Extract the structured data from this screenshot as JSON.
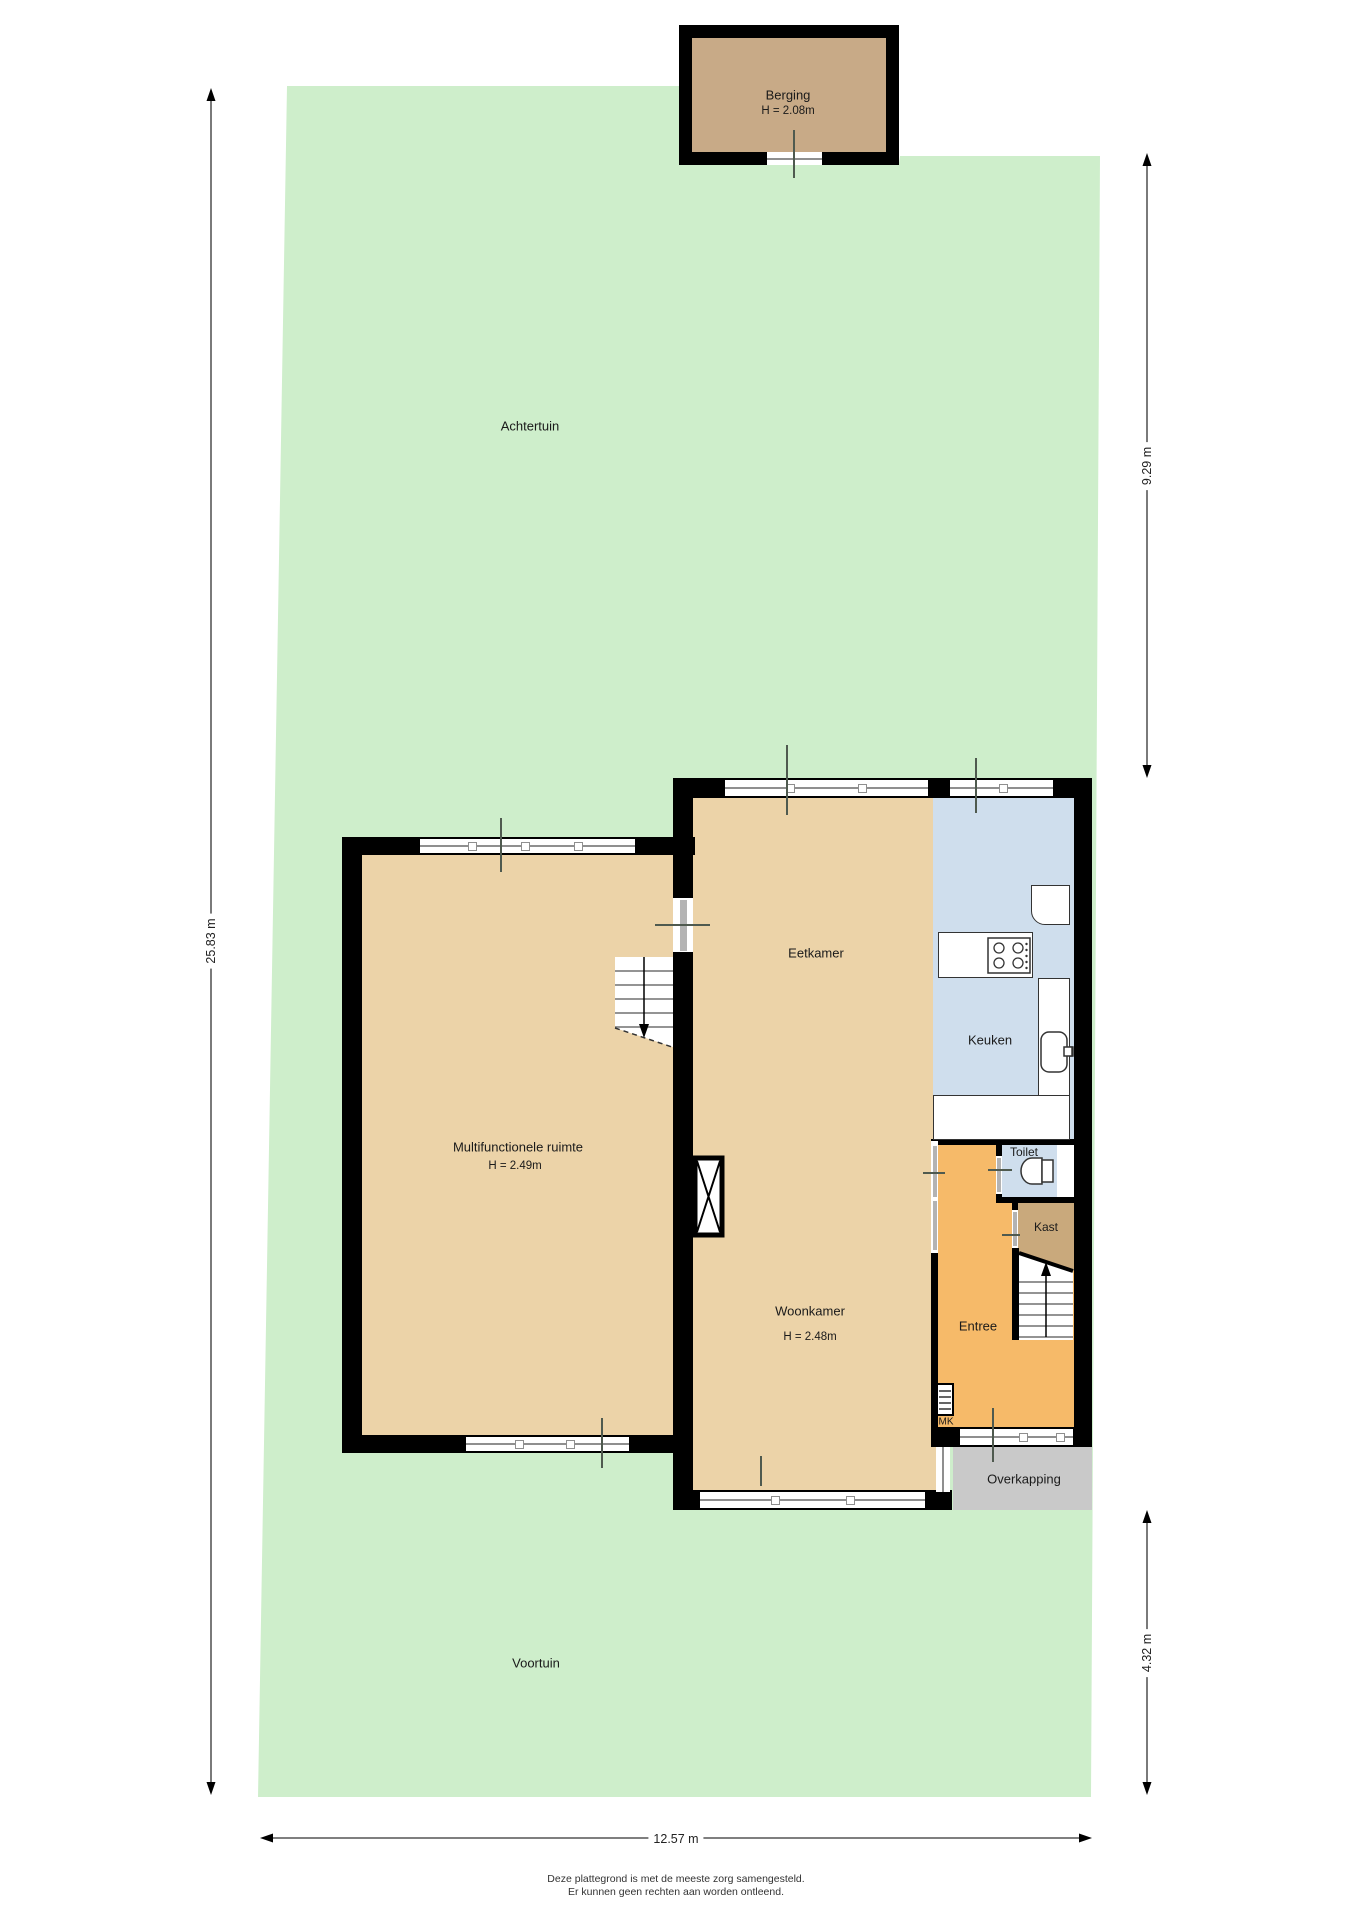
{
  "plan": {
    "title": "Begane grond plattegrond",
    "rooms": {
      "achtertuin": {
        "label": "Achtertuin"
      },
      "voortuin": {
        "label": "Voortuin"
      },
      "berging": {
        "label": "Berging",
        "height": "H = 2.08m"
      },
      "multifunctionele_ruimte": {
        "label": "Multifunctionele ruimte",
        "height": "H = 2.49m"
      },
      "eetkamer": {
        "label": "Eetkamer"
      },
      "keuken": {
        "label": "Keuken"
      },
      "toilet": {
        "label": "Toilet"
      },
      "kast": {
        "label": "Kast"
      },
      "woonkamer": {
        "label": "Woonkamer",
        "height": "H = 2.48m"
      },
      "entree": {
        "label": "Entree"
      },
      "overkapping": {
        "label": "Overkapping"
      },
      "meterkast": {
        "label": "MK"
      }
    },
    "dimensions": {
      "left": "25.83 m",
      "right_top": "9.29 m",
      "right_bottom": "4.32 m",
      "bottom": "12.57 m"
    },
    "footer": {
      "line1": "Deze plattegrond is met de meeste zorg samengesteld.",
      "line2": "Er kunnen geen rechten aan worden ontleend."
    },
    "colors": {
      "garden": "#ceeecb",
      "room_tan": "#ecd3a8",
      "berging_fill": "#c8aa87",
      "kast_fill": "#c9a97c",
      "entree_orange": "#f6ba69",
      "kitchen_blue": "#cfdeed",
      "overkapping_gray": "#c9c9c9",
      "wall": "#000000"
    }
  }
}
